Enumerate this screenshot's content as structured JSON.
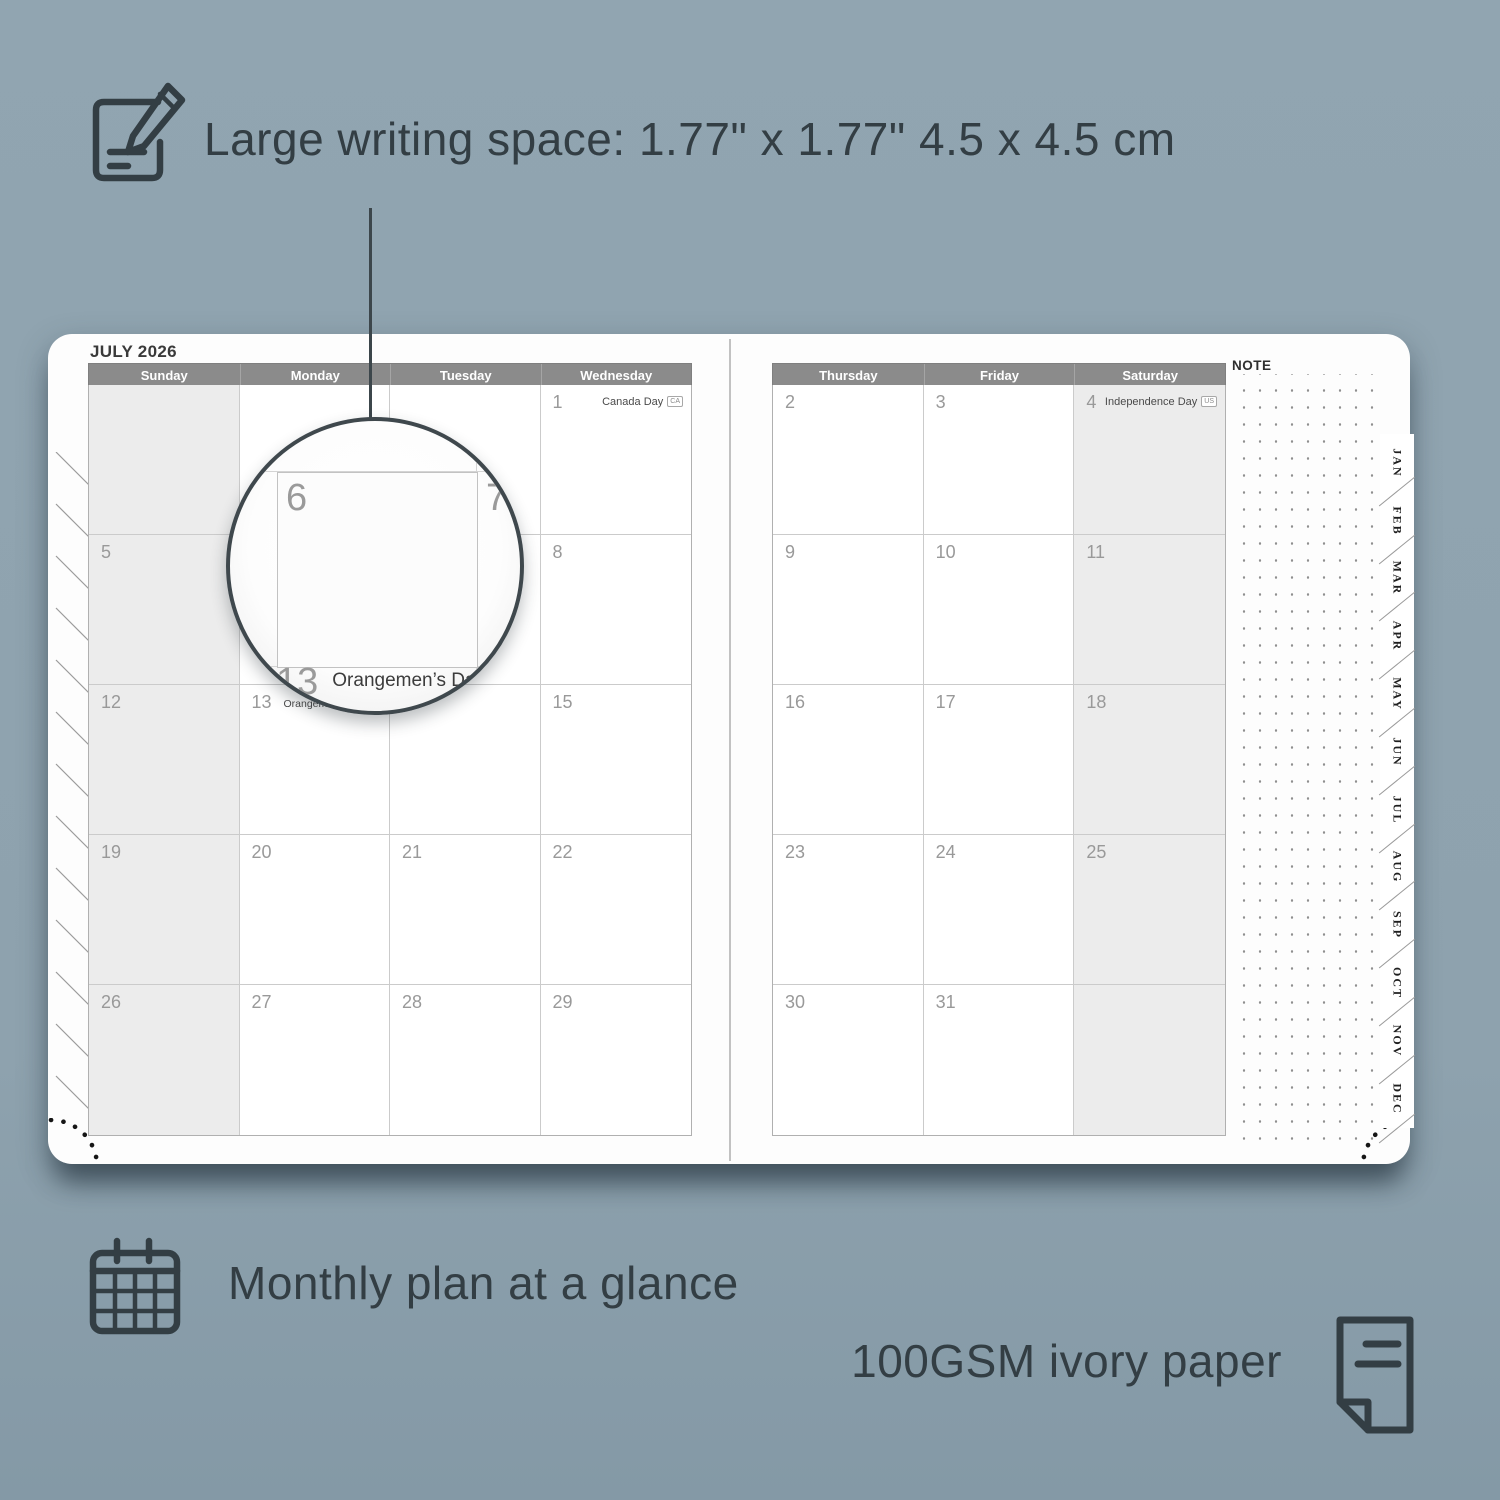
{
  "colors": {
    "background": "#8ea2ae",
    "ink": "#333e44",
    "header_bar": "#8b8b8b",
    "weekend_cell": "#ececec",
    "grid_line": "#cbcbcb",
    "day_number": "#999999",
    "page": "#fdfdfd"
  },
  "annotations": {
    "writing_space": {
      "icon": "pencil-note-icon",
      "text": "Large writing space: 1.77\" x 1.77\" 4.5 x 4.5 cm"
    },
    "monthly_plan": {
      "icon": "calendar-grid-icon",
      "text": "Monthly plan at a glance"
    },
    "paper": {
      "icon": "paper-sheet-icon",
      "text": "100GSM ivory paper"
    }
  },
  "planner": {
    "month_title": "JULY 2026",
    "note_label": "NOTE",
    "left_page_days": [
      "Sunday",
      "Monday",
      "Tuesday",
      "Wednesday"
    ],
    "right_page_days": [
      "Thursday",
      "Friday",
      "Saturday"
    ],
    "left_rows": [
      [
        {
          "num": ""
        },
        {
          "num": ""
        },
        {
          "num": ""
        },
        {
          "num": "1",
          "holiday": "Canada Day",
          "flag": "CA",
          "align": "right"
        }
      ],
      [
        {
          "num": "5"
        },
        {
          "num": "6"
        },
        {
          "num": "7"
        },
        {
          "num": "8"
        }
      ],
      [
        {
          "num": "12"
        },
        {
          "num": "13",
          "holiday": "Orangemen’s Day (n.i.)",
          "flag": "UK",
          "align": "left"
        },
        {
          "num": "14"
        },
        {
          "num": "15"
        }
      ],
      [
        {
          "num": "19"
        },
        {
          "num": "20"
        },
        {
          "num": "21"
        },
        {
          "num": "22"
        }
      ],
      [
        {
          "num": "26"
        },
        {
          "num": "27"
        },
        {
          "num": "28"
        },
        {
          "num": "29"
        }
      ]
    ],
    "right_rows": [
      [
        {
          "num": "2"
        },
        {
          "num": "3"
        },
        {
          "num": "4",
          "holiday": "Independence Day",
          "flag": "US",
          "align": "right"
        }
      ],
      [
        {
          "num": "9"
        },
        {
          "num": "10"
        },
        {
          "num": "11"
        }
      ],
      [
        {
          "num": "16"
        },
        {
          "num": "17"
        },
        {
          "num": "18"
        }
      ],
      [
        {
          "num": "23"
        },
        {
          "num": "24"
        },
        {
          "num": "25"
        }
      ],
      [
        {
          "num": "30"
        },
        {
          "num": "31"
        },
        {
          "num": ""
        }
      ]
    ],
    "month_tabs": [
      "JAN",
      "FEB",
      "MAR",
      "APR",
      "MAY",
      "JUN",
      "JUL",
      "AUG",
      "SEP",
      "OCT",
      "NOV",
      "DEC"
    ],
    "magnifier": {
      "day_top_left": "6",
      "day_top_right": "7",
      "day_bottom": "13",
      "holiday": "Orangemen’s Day (n.i.)",
      "flag": "UK"
    }
  }
}
